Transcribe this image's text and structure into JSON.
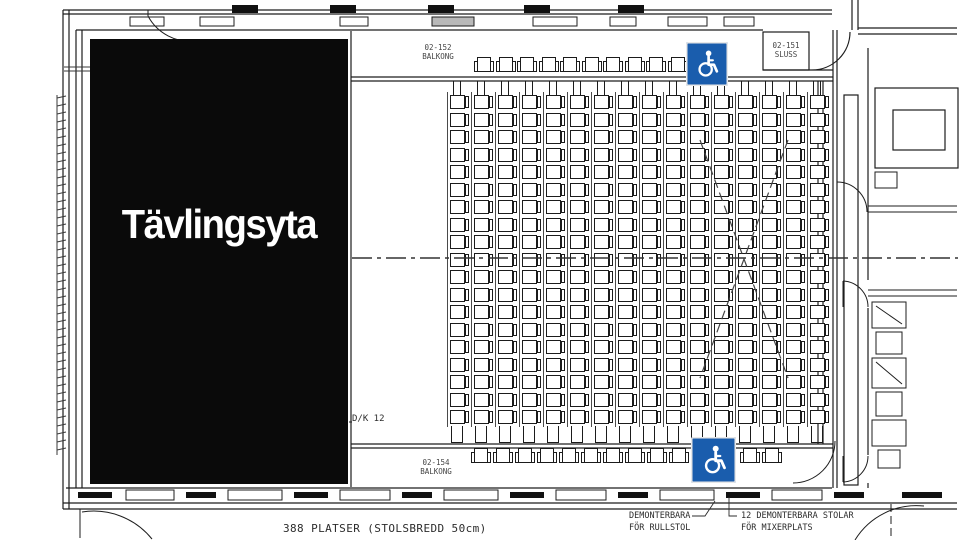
{
  "competition_area": {
    "label": "Tävlingsyta"
  },
  "rooms": {
    "balcony_top": {
      "number": "02-152",
      "name": "BALKONG"
    },
    "sluss": {
      "number": "02-151",
      "name": "SLUSS"
    },
    "balcony_bottom": {
      "number": "02-154",
      "name": "BALKONG"
    }
  },
  "notes": {
    "dk": "D/K 12",
    "total_seats": "388 PLATSER (STOLSBREDD 50cm)",
    "removable_wheelchair": [
      "DEMONTERBARA",
      "FÖR RULLSTOL"
    ],
    "removable_mixer": [
      "12 DEMONTERBARA STOLAR",
      "FÖR MIXERPLATS"
    ]
  },
  "colors": {
    "accessible_blue": "#1a5dad",
    "line": "#1d1d1d",
    "competition_bg": "#0a0a0a"
  },
  "seating": {
    "main_block": {
      "columns": 16,
      "rows": 19,
      "x": 450,
      "y": 95,
      "col_spacing": 24,
      "row_spacing": 17.5,
      "seat_width": 15,
      "seat_height": 14
    },
    "balcony_top_row": {
      "count": 10,
      "x": 477,
      "y": 57,
      "spacing": 21.5,
      "w": 14,
      "h": 15
    },
    "balcony_bottom_row": {
      "count": 10,
      "x": 474,
      "y": 448,
      "spacing": 22,
      "w": 14,
      "h": 15
    },
    "balcony_bottom_right_row": {
      "count": 2,
      "x": 743,
      "y": 448,
      "spacing": 22,
      "w": 14,
      "h": 15
    }
  }
}
